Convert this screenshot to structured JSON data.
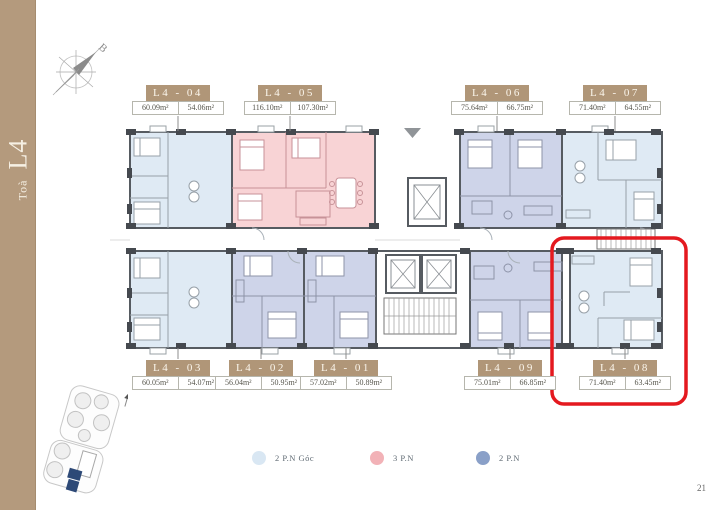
{
  "page": {
    "tower_label_small": "Toà",
    "tower_label_big": "L4",
    "compass_letter": "B",
    "page_number": "21"
  },
  "legend": {
    "items": [
      {
        "label": "2 P.N Góc",
        "color": "#d9e7f3",
        "plan_color": "#dfeaf4"
      },
      {
        "label": "3 P.N",
        "color": "#f2b2b7",
        "plan_color": "#f8d3d5"
      },
      {
        "label": "2 P.N",
        "color": "#8aa0c8",
        "plan_color": "#ced4e9"
      }
    ]
  },
  "units": [
    {
      "code": "L4 - 04",
      "area_left": "60.09m²",
      "area_right": "54.06m²",
      "type": 0
    },
    {
      "code": "L4 - 05",
      "area_left": "116.10m²",
      "area_right": "107.30m²",
      "type": 1
    },
    {
      "code": "L4 - 06",
      "area_left": "75.64m²",
      "area_right": "66.75m²",
      "type": 2
    },
    {
      "code": "L4 - 07",
      "area_left": "71.40m²",
      "area_right": "64.55m²",
      "type": 0
    },
    {
      "code": "L4 - 03",
      "area_left": "60.05m²",
      "area_right": "54.07m²",
      "type": 0
    },
    {
      "code": "L4 - 02",
      "area_left": "56.04m²",
      "area_right": "50.95m²",
      "type": 2
    },
    {
      "code": "L4 - 01",
      "area_left": "57.02m²",
      "area_right": "50.89m²",
      "type": 2
    },
    {
      "code": "L4 - 09",
      "area_left": "75.01m²",
      "area_right": "66.85m²",
      "type": 2
    },
    {
      "code": "L4 - 08",
      "area_left": "71.40m²",
      "area_right": "63.45m²",
      "type": 0
    }
  ],
  "highlight": {
    "unit": "L4 - 08",
    "color": "#e4191f"
  }
}
